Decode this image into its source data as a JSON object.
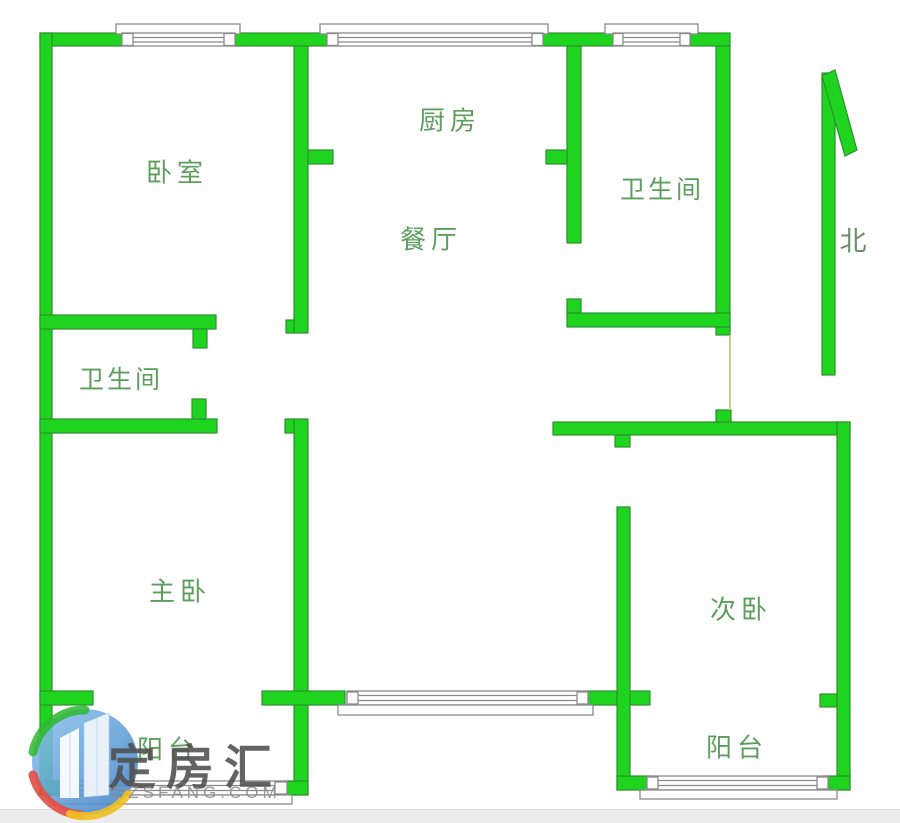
{
  "floorplan": {
    "rooms": {
      "bedroom": {
        "label": "卧室"
      },
      "kitchen": {
        "label": "厨房"
      },
      "dining": {
        "label": "餐厅"
      },
      "bathroom_right": {
        "label": "卫生间"
      },
      "bathroom_left": {
        "label": "卫生间"
      },
      "master_bedroom": {
        "label": "主卧"
      },
      "second_bedroom": {
        "label": "次卧"
      },
      "balcony_left": {
        "label": "阳台"
      },
      "balcony_right": {
        "label": "阳台"
      }
    },
    "compass": {
      "north_label": "北"
    },
    "colors": {
      "wall_fill": "#1ed41e",
      "wall_stroke": "#2f8f2f",
      "window_stroke": "#8a8a8a",
      "label_text": "#5c9e5c"
    }
  },
  "watermark": {
    "brand_name": "定房汇",
    "brand_domain": "DZSFANG.COM"
  }
}
